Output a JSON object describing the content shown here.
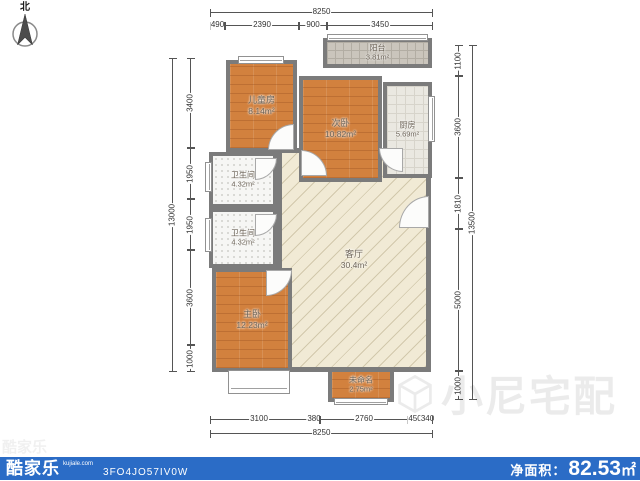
{
  "compass": {
    "north_label": "北"
  },
  "rooms": {
    "balcony": {
      "name": "阳台",
      "area": "3.81m²"
    },
    "children": {
      "name": "儿童房",
      "area": "8.14m²"
    },
    "secondary": {
      "name": "次卧",
      "area": "10.82m²"
    },
    "kitchen": {
      "name": "厨房",
      "area": "5.69m²"
    },
    "bath1": {
      "name": "卫生间",
      "area": "4.32m²"
    },
    "bath2": {
      "name": "卫生间",
      "area": "4.32m²"
    },
    "living": {
      "name": "客厅",
      "area": "30.4m²"
    },
    "master": {
      "name": "主卧",
      "area": "12.23m²"
    },
    "unnamed": {
      "name": "未命名",
      "area": "2.75m²"
    }
  },
  "dimensions": {
    "top": {
      "overall": "8250",
      "segments": [
        "490",
        "2390",
        "900",
        "3450"
      ]
    },
    "bottom": {
      "overall": "8250",
      "segments": [
        "3100",
        "380",
        "2760",
        "450",
        "340"
      ]
    },
    "left": {
      "overall": "13000",
      "segments": [
        "3400",
        "1950",
        "1950",
        "3600",
        "1000"
      ]
    },
    "right": {
      "overall": "13500",
      "segments": [
        "1100",
        "3600",
        "1810",
        "5000",
        "1000"
      ]
    }
  },
  "watermark": {
    "text": "小尼宅配",
    "faint_brand": "酷家乐"
  },
  "footer": {
    "brand": "酷家乐",
    "brand_domain": "kujiale.com",
    "plan_code": "3FO4JO57IV0W",
    "net_area_label": "净面积：",
    "net_area_value": "82.53",
    "net_area_unit": "㎡"
  },
  "colors": {
    "footer_bg": "#2b6cc6",
    "wall": "#7b7b7b",
    "wood_floor": "#d2813e",
    "living_floor": "#f1ead5",
    "kitchen_floor": "#eae8e1",
    "balcony_floor": "#cac5bc",
    "bath_floor": "#f6f6f4"
  }
}
